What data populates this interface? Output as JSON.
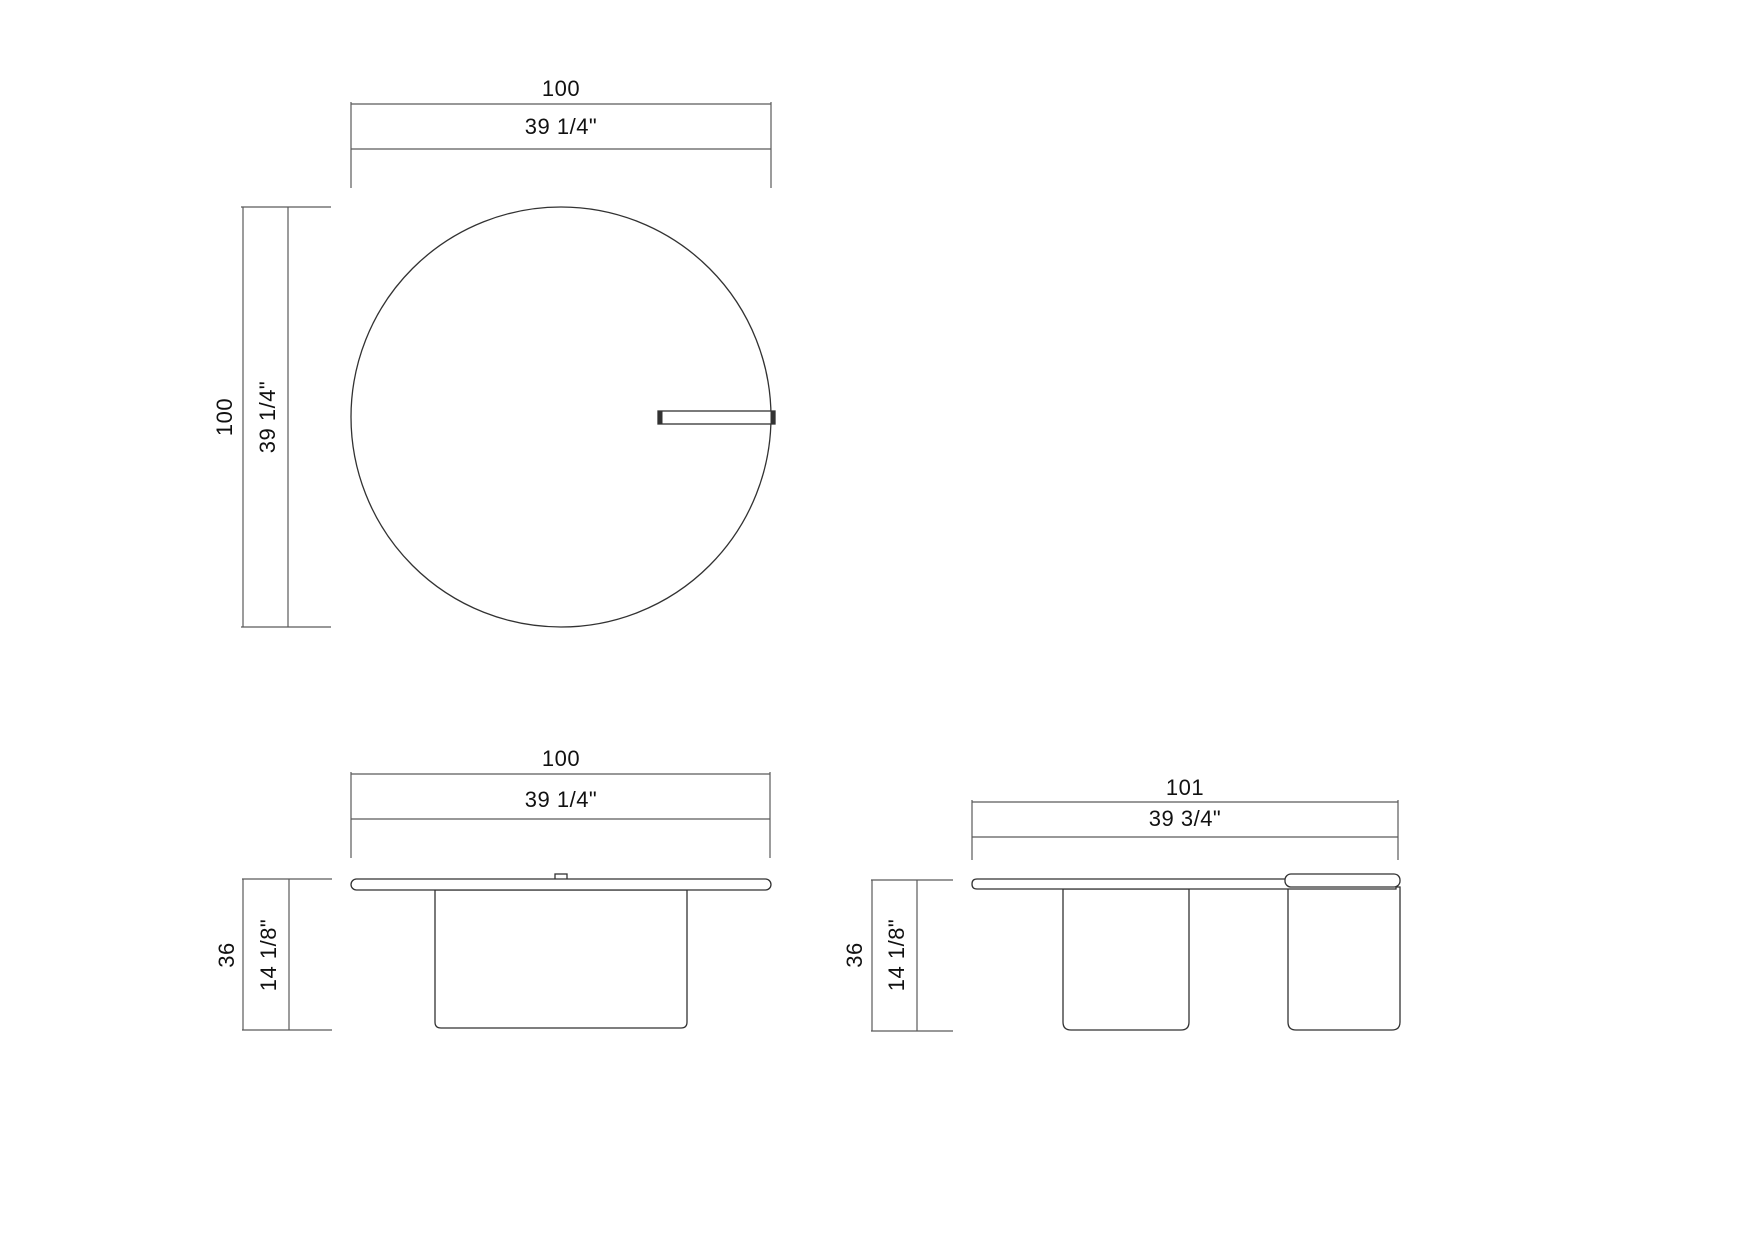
{
  "page": {
    "background_color": "#ffffff",
    "dimension_line_color": "#5a5a5a",
    "object_line_color": "#323232",
    "text_color": "#111111"
  },
  "views": {
    "top_view": {
      "width_dim": {
        "metric": "100",
        "imperial": "39 1/4\""
      },
      "height_dim": {
        "metric": "100",
        "imperial": "39 1/4\""
      }
    },
    "front_view": {
      "width_dim": {
        "metric": "100",
        "imperial": "39 1/4\""
      },
      "height_dim": {
        "metric": "36",
        "imperial": "14 1/8\""
      }
    },
    "side_view": {
      "width_dim": {
        "metric": "101",
        "imperial": "39 3/4\""
      },
      "height_dim": {
        "metric": "36",
        "imperial": "14 1/8\""
      }
    }
  }
}
